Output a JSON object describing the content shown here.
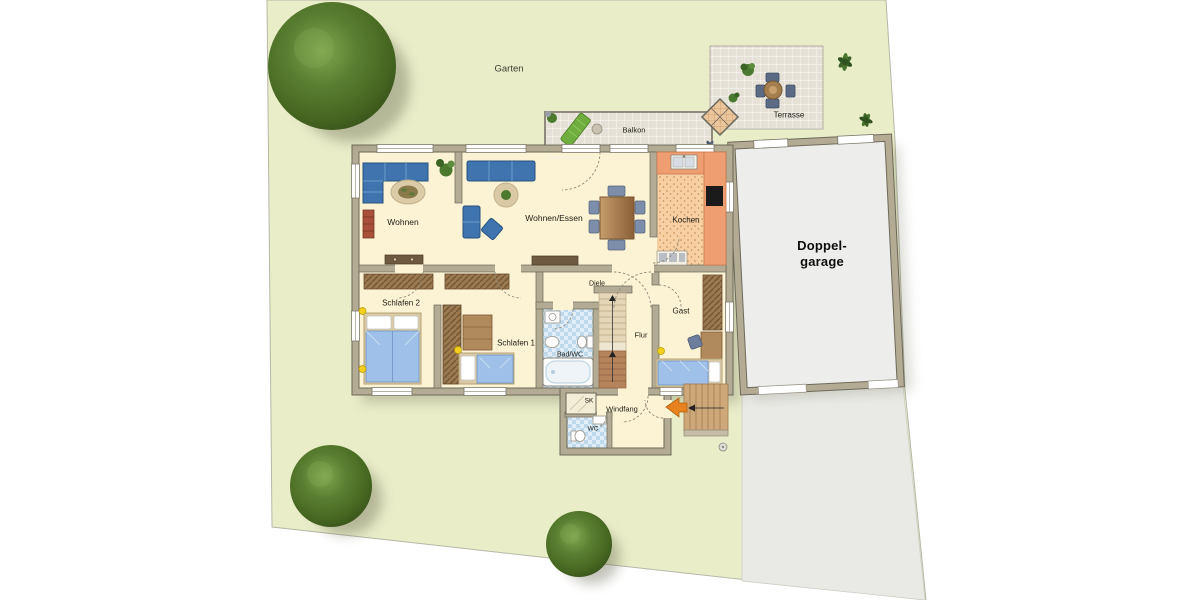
{
  "labels": {
    "garten": "Garten",
    "balkon": "Balkon",
    "terrasse": "Terrasse",
    "wohnen": "Wohnen",
    "wohnen_essen": "Wohnen/Essen",
    "kochen": "Kochen",
    "garage_line1": "Doppel-",
    "garage_line2": "garage",
    "schlafen2": "Schlafen 2",
    "schlafen1": "Schlafen 1",
    "bad_wc": "Bad/WC",
    "diele": "Diele",
    "flur": "Flur",
    "gast": "Gast",
    "sk": "SK",
    "windfang": "Windfang",
    "wc": "WC",
    "watermark": "©grundrissprofi.de"
  },
  "colors": {
    "garden_green": "#e9edc8",
    "floor_cream": "#fbf3d3",
    "wall_beige": "#b3ab93",
    "kitchen_orange": "#ef9e72",
    "bath_blue": "#cfe4f2",
    "sofa_blue": "#3f74ae",
    "bed_blue": "#9fc0e8",
    "wood_brown": "#a8835a",
    "garage_gray": "#ededeb",
    "driveway_gray": "#e9e9e5",
    "tile_gray": "#e5e1d6",
    "arrow_orange": "#e8821e",
    "light_dot_yellow": "#f2cf1f",
    "tree_green": "#5a7f31"
  }
}
